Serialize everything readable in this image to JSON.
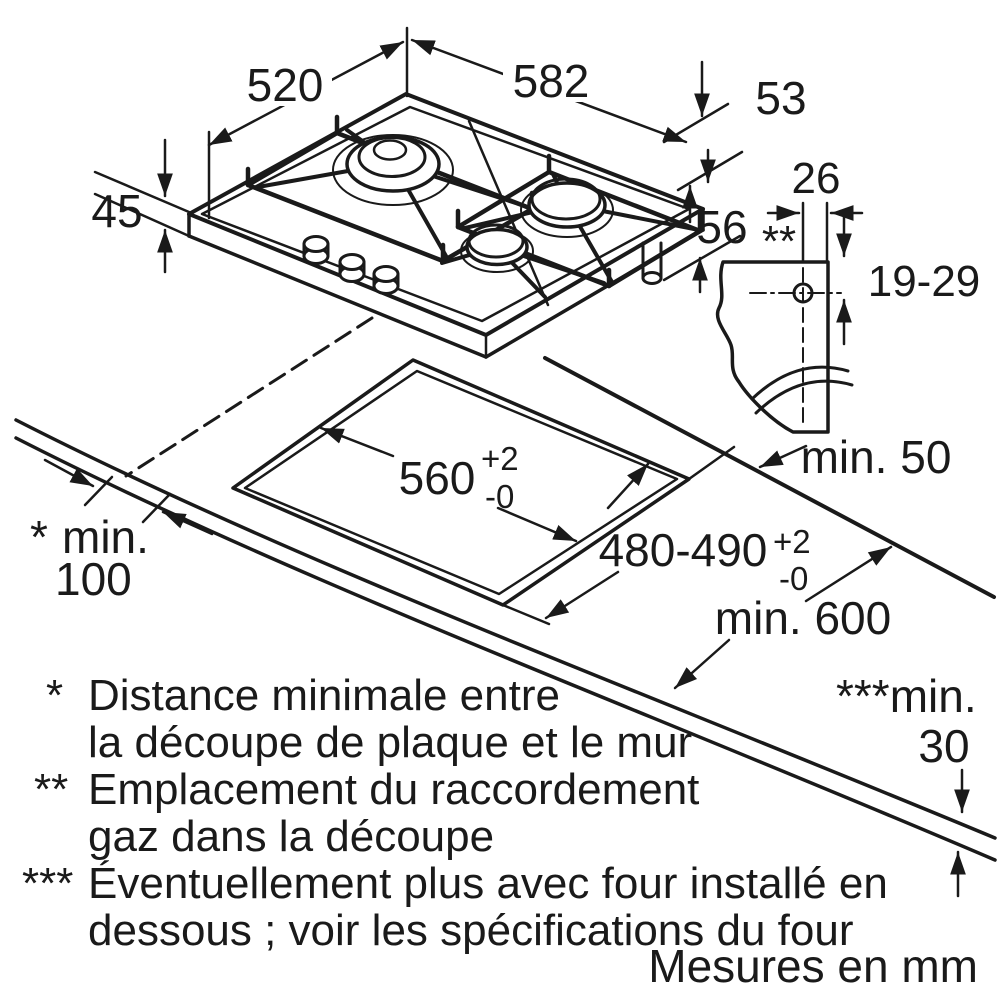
{
  "dimensions": {
    "hob_width": "520",
    "hob_total_width": "582",
    "hob_edge": "53",
    "hob_height": "45",
    "gas_position": "56",
    "gas_position_marker": "**",
    "hole_offset": "26",
    "hole_range": "19-29",
    "cutout_width": "560",
    "cutout_width_plus": "+2",
    "cutout_width_minus": "-0",
    "cutout_depth": "480-490",
    "cutout_depth_plus": "+2",
    "cutout_depth_minus": "-0",
    "min_side": "min. 50",
    "min_wall_marker": "*",
    "min_wall_label": "min.",
    "min_wall_value": "100",
    "min_worktop": "min. 600",
    "min_below_label": "***min.",
    "min_below_value": "30"
  },
  "footnotes": {
    "star1_marker": "*",
    "star1_line1": "Distance minimale entre",
    "star1_line2": "la découpe de plaque et le mur",
    "star2_marker": "**",
    "star2_line1": "Emplacement du raccordement",
    "star2_line2": "gaz dans la découpe",
    "star3_marker": "***",
    "star3_line1": "Éventuellement plus avec four installé en",
    "star3_line2": "dessous ; voir les spécifications du four"
  },
  "caption": "Mesures en mm",
  "colors": {
    "line": "#1a1a1a",
    "burner_fill": "#c9c9c9",
    "burner_fill_light": "#d8d8d8"
  }
}
